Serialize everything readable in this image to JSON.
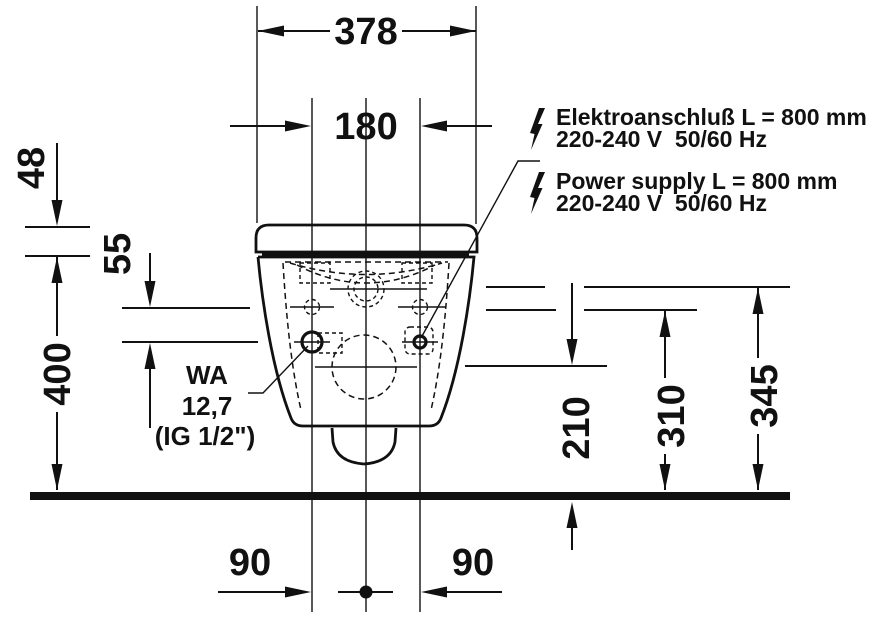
{
  "colors": {
    "ink": "#111111",
    "background": "#ffffff"
  },
  "dims": {
    "overall_width": "378",
    "fixing_hole_spacing": "180",
    "seat_drop": "48",
    "hole_water_offset": "55",
    "rim_height": "400",
    "outlet_center_height": "210",
    "fixing_hole_height": "310",
    "water_supply_height": "345",
    "hole_center_left": "90",
    "hole_center_right": "90"
  },
  "power_label": {
    "de_line1": "Elektroanschluß L = 800 mm",
    "de_line2": "220-240 V  50/60 Hz",
    "en_line1": "Power supply L = 800 mm",
    "en_line2": "220-240 V  50/60 Hz"
  },
  "water_label": {
    "line1": "WA",
    "line2": "12,7",
    "line3": "(IG 1/2\")"
  },
  "icons": {
    "power_de": "lightning-bolt-icon",
    "power_en": "lightning-bolt-icon"
  }
}
